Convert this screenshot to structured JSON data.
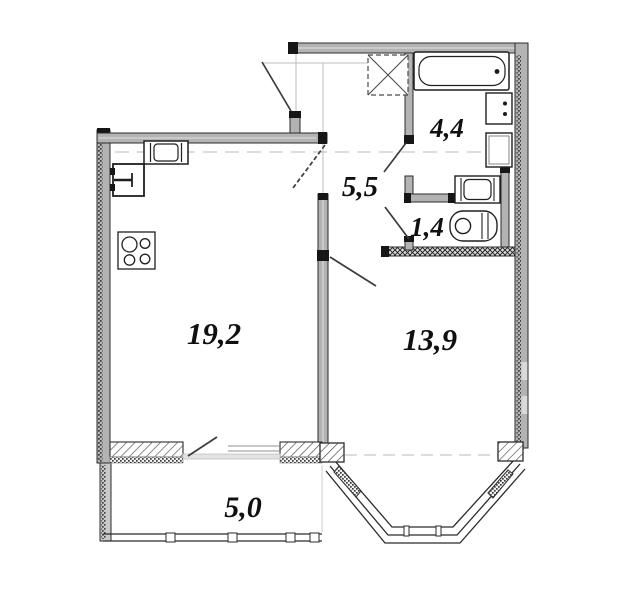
{
  "plan": {
    "rooms": {
      "living_kitchen": {
        "area": "19,2"
      },
      "bedroom": {
        "area": "13,9"
      },
      "hallway": {
        "area": "5,5"
      },
      "bathroom": {
        "area": "4,4"
      },
      "wc": {
        "area": "1,4"
      },
      "balcony": {
        "area": "5,0"
      }
    },
    "fixtures": [
      "kitchen-sink",
      "refrigerator",
      "stove-4-burner",
      "vent-shaft",
      "bathtub",
      "washbasin",
      "washing-machine",
      "toilet",
      "laundry-unit"
    ],
    "colors": {
      "background": "#ffffff",
      "wall_fill": "#b3b3b3",
      "wall_edge": "#2b2b2b",
      "wall_cap": "#161616",
      "construction_line": "#c7c7c7",
      "label": "#101010"
    }
  }
}
